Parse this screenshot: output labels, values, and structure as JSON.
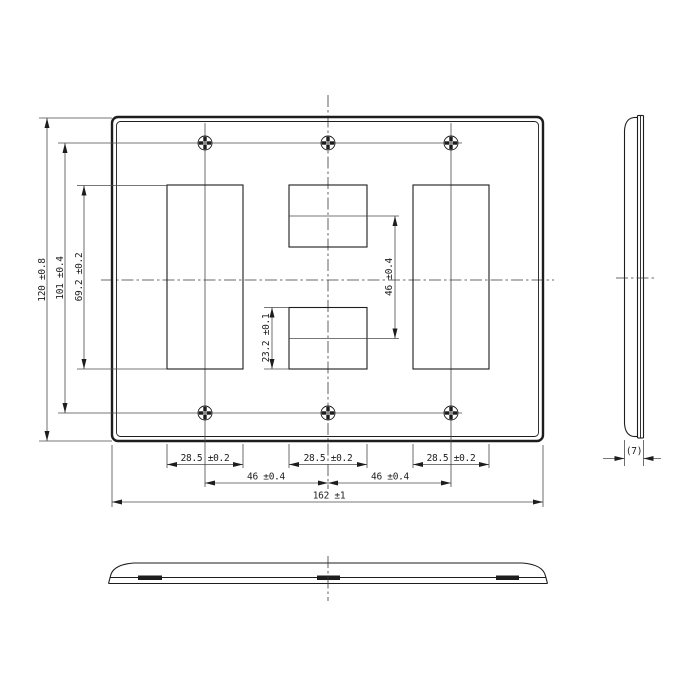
{
  "meta": {
    "drawing_type": "engineering dimension drawing",
    "background_color": "#ffffff",
    "line_color": "#1d1d1d",
    "units_shown": "mm"
  },
  "front_view": {
    "dim_overall_height": "120 ±0.8",
    "dim_screw_pitch_vertical": "101 ±0.4",
    "dim_opening_height": "69.2 ±0.2",
    "dim_center_opening_pitch": "46 ±0.4",
    "dim_small_opening_height": "23.2 ±0.1",
    "dim_opening_width_left": "28.5 ±0.2",
    "dim_opening_width_center": "28.5 ±0.2",
    "dim_opening_width_right": "28.5 ±0.2",
    "dim_gang_pitch_left": "46 ±0.4",
    "dim_gang_pitch_right": "46 ±0.4",
    "dim_overall_width": "162 ±1",
    "screw_hole_count": 6,
    "opening_count": 4
  },
  "side_view": {
    "dim_thickness": "(7)"
  },
  "bottom_view": {
    "tab_count": 3
  }
}
